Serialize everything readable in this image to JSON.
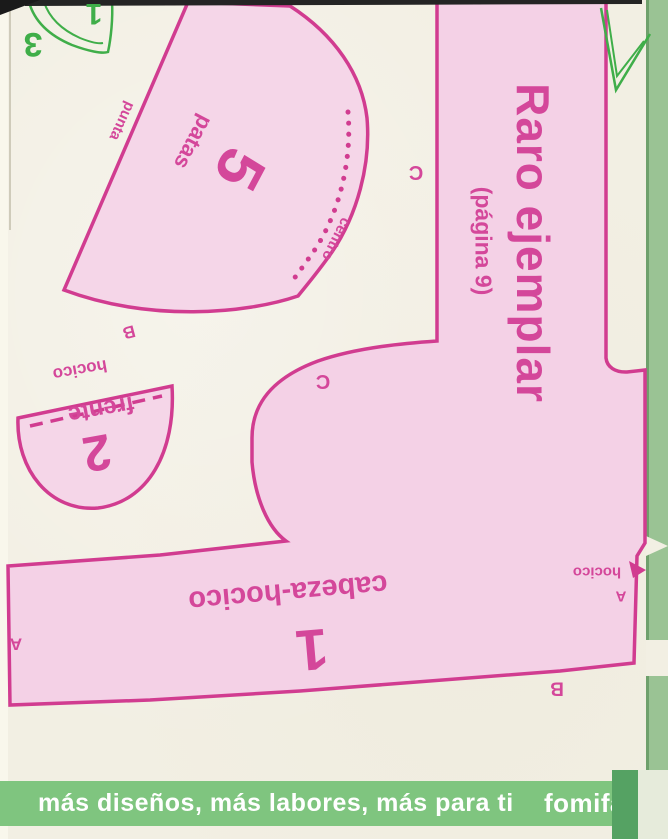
{
  "header": {
    "title": "Raro ejemplar",
    "subtitle": "(página 9)"
  },
  "corner_marks": {
    "piece_three": "3",
    "piece_one": "1"
  },
  "pieces": {
    "patas": {
      "number": "5",
      "name": "patas",
      "edge_left": "punta",
      "edge_right": "centro",
      "join_mark": "B"
    },
    "frente": {
      "number": "2",
      "name": "frente",
      "edge_top": "hocico"
    },
    "cabeza": {
      "number": "1",
      "name": "cabeza-hocico",
      "join_a_left": "A",
      "join_a_right": "A",
      "join_b": "B",
      "edge_right": "hocico"
    }
  },
  "center_marks": {
    "c_upper": "C",
    "c_lower": "C"
  },
  "footer": {
    "tagline": "más diseños, más labores, más para ti",
    "brand": "fomifác"
  },
  "colors": {
    "paper": "#f2efe3",
    "piece_fill": "#f5d5e8",
    "outline": "#d13c90",
    "label_text": "#d4479a",
    "corner_green": "#3fae49",
    "banner_green": "#7fc57f",
    "edge_strip_green": "#9ac394",
    "fold_green_dark": "#55a263",
    "banner_text": "#ffffff"
  }
}
